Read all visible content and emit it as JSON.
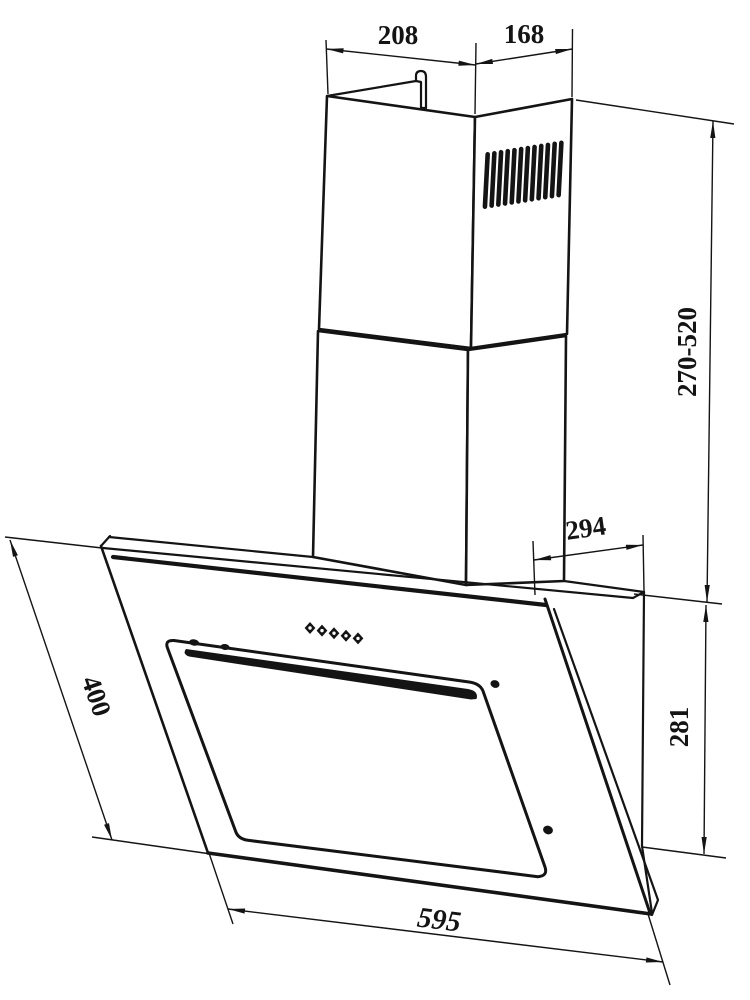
{
  "diagram": {
    "type": "technical-dimension-drawing",
    "subject": "wall-mounted angled cooker hood with telescopic chimney",
    "background_color": "#ffffff",
    "line_color": "#141414",
    "dimensions": {
      "chimney_top_width": "208",
      "chimney_top_depth": "168",
      "chimney_height_range": "270-520",
      "hood_top_depth": "294",
      "hood_rear_height": "281",
      "hood_panel_length": "400",
      "hood_width": "595"
    },
    "features": {
      "vent_slot_count": 12,
      "control_button_count": 5,
      "screw_hole_count": 2
    }
  }
}
